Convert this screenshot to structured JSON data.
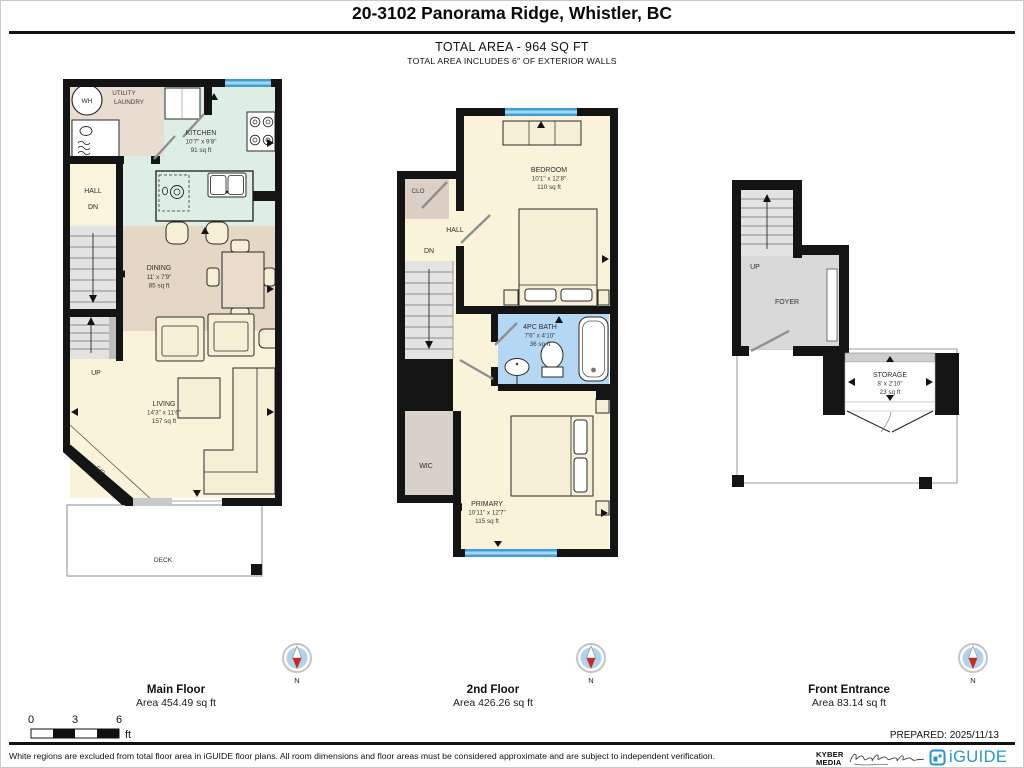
{
  "header": {
    "title": "20-3102 Panorama Ridge, Whistler, BC",
    "total_area": "TOTAL AREA - 964 SQ FT",
    "total_note": "TOTAL AREA INCLUDES 6\" OF EXTERIOR WALLS"
  },
  "plans": {
    "main": {
      "label": "Main Floor",
      "area_label": "Area 454.49 sq ft",
      "rooms": {
        "wh": "WH",
        "utility1": "UTILITY",
        "utility2": "LAUNDRY",
        "kitchen": {
          "name": "KITCHEN",
          "dims": "10'7\" x 9'8\"",
          "area": "91 sq ft"
        },
        "hall": "HALL",
        "dn": "DN",
        "dining": {
          "name": "DINING",
          "dims": "11' x 7'9\"",
          "area": "85 sq ft"
        },
        "up": "UP",
        "living": {
          "name": "LIVING",
          "dims": "14'3\" x 11'6\"",
          "area": "157 sq ft"
        },
        "fireplace": "F/P",
        "deck": "DECK"
      }
    },
    "second": {
      "label": "2nd Floor",
      "area_label": "Area 426.26 sq ft",
      "rooms": {
        "clo": "CLO",
        "hall": "HALL",
        "dn": "DN",
        "bedroom": {
          "name": "BEDROOM",
          "dims": "10'1\" x 12'8\"",
          "area": "110 sq ft"
        },
        "bath": {
          "name": "4PC BATH",
          "dims": "7'6\" x 4'10\"",
          "area": "36 sq ft"
        },
        "wic": "WIC",
        "primary": {
          "name": "PRIMARY",
          "dims": "10'11\" x 12'7\"",
          "area": "115 sq ft"
        }
      }
    },
    "entrance": {
      "label": "Front Entrance",
      "area_label": "Area 83.14 sq ft",
      "rooms": {
        "up": "UP",
        "foyer": "FOYER",
        "storage": {
          "name": "STORAGE",
          "dims": "8' x 2'10\"",
          "area": "23 sq ft"
        }
      }
    }
  },
  "compass": {
    "label": "N"
  },
  "scale": {
    "t0": "0",
    "t1": "3",
    "t2": "6",
    "unit": "ft"
  },
  "prepared": "PREPARED: 2025/11/13",
  "footer": {
    "disclaimer": "White regions are excluded from total floor area in iGUIDE floor plans. All room dimensions and floor areas must be considered approximate and are subject to independent verification.",
    "brand1": "KYBER",
    "brand2": "MEDIA",
    "logo": "iGUIDE"
  },
  "colors": {
    "wall": "#141414",
    "window_blue": "#3e9fd8",
    "window_light": "#a6d7ef",
    "kitchen_mint": "#dfeee5",
    "utility_beige": "#e9ddd1",
    "dining_tan": "#e4d7c5",
    "cream": "#faf3da",
    "bath_blue": "#b4d8f3",
    "wic_gray": "#d7d1ca",
    "foyer_gray": "#d9d9d9",
    "stairs_gray": "#e3e3e3",
    "compass_blue": "#aed3ee",
    "compass_red": "#d02820",
    "brand_blue": "#2496cf"
  }
}
